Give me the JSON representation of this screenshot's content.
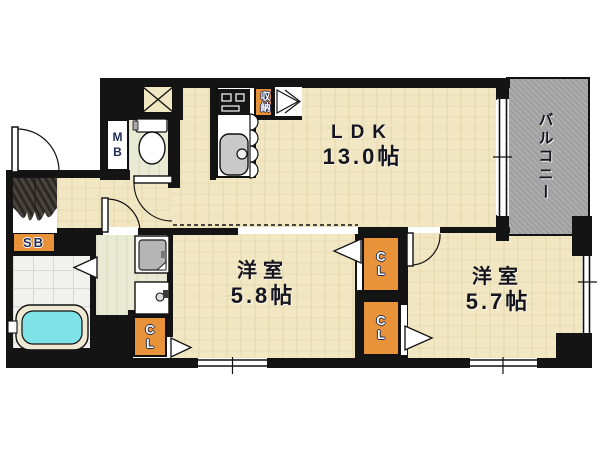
{
  "floorplan": {
    "rooms": {
      "ldk": {
        "name": "LDK",
        "size": "13.0帖"
      },
      "bedroom_a": {
        "name": "洋室",
        "size": "5.8帖"
      },
      "bedroom_b": {
        "name": "洋室",
        "size": "5.7帖"
      },
      "balcony": {
        "name": "バルコニー"
      }
    },
    "labels": {
      "meter_box": "MB",
      "shaft_box": "SB",
      "closet": "CL",
      "storage": "収納"
    },
    "colors": {
      "floor": "#f2e7c3",
      "wall": "#141414",
      "balcony": "#acacac",
      "accent_orange": "#e8923a",
      "bathtub": "#7ee2e6",
      "tile": "#f1f1ed",
      "washroom": "#e9ead3",
      "entrance": "#3b372f"
    }
  }
}
